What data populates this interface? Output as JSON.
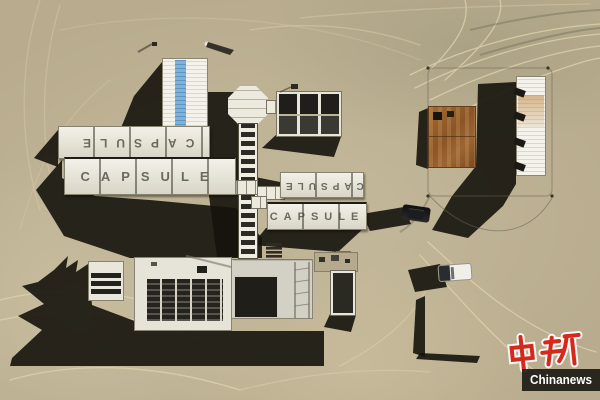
{
  "scene": {
    "description": "Aerial top-down photograph of a desert camp built from white capsule container modules linked by corridors, with rust-roofed sheds, a white pickup truck, a dark SUV and circular vehicle tracks in the sand"
  },
  "capsule_rows": [
    {
      "id": "west-upper",
      "text": "CAPSULE",
      "orientation": "inverted"
    },
    {
      "id": "west-lower",
      "text": "CAPSULE",
      "orientation": "normal"
    },
    {
      "id": "center-upper",
      "text": "CAPSULE",
      "orientation": "inverted"
    },
    {
      "id": "center-lower",
      "text": "CAPSULE",
      "orientation": "normal"
    }
  ],
  "watermark": {
    "logo_text": "中新",
    "wordmark": "Chinanews"
  },
  "colors": {
    "sand": "#b9ac8e",
    "sand_track": "#ded2ad",
    "shadow": "#15130c",
    "building_white": "#ece9dd",
    "panel_dark": "#22211d",
    "blue_stripe": "#6ba3cf",
    "rust": "#96603a",
    "logo_red": "#d42a1e",
    "bar_bg": "#16140f",
    "bar_text": "#ffffff"
  }
}
